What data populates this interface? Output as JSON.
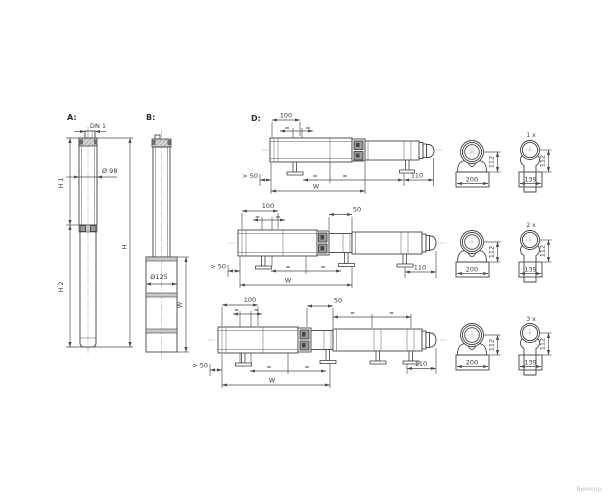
{
  "watermark": "Вимкор",
  "pump_a": {
    "label": "A:",
    "dn": "DN 1",
    "diameter": "Ø 98",
    "h1": "H 1",
    "h2": "H 2",
    "h_total": "H"
  },
  "pump_b": {
    "label": "B:",
    "diameter": "Ø125",
    "width": "W"
  },
  "assembly": {
    "label": "D:",
    "rows": [
      {
        "top": "100",
        "eq": "=",
        "left": "> 50",
        "right": "110",
        "width": "W"
      },
      {
        "top": "100",
        "top2": "50",
        "eq": "=",
        "left": "> 50",
        "right": "110",
        "width": "W"
      },
      {
        "top": "100",
        "top2": "50",
        "eq": "=",
        "left": "> 50",
        "right": "110",
        "width": "W"
      }
    ]
  },
  "sections": [
    {
      "count": "1 x",
      "saddle_width": "200",
      "height": "112",
      "clamp_width": "139",
      "clamp_height": "112"
    },
    {
      "count": "2 x",
      "saddle_width": "200",
      "height": "112",
      "clamp_width": "139",
      "clamp_height": "112"
    },
    {
      "count": "3 x",
      "saddle_width": "200",
      "height": "112",
      "clamp_width": "139",
      "clamp_height": "112"
    }
  ]
}
